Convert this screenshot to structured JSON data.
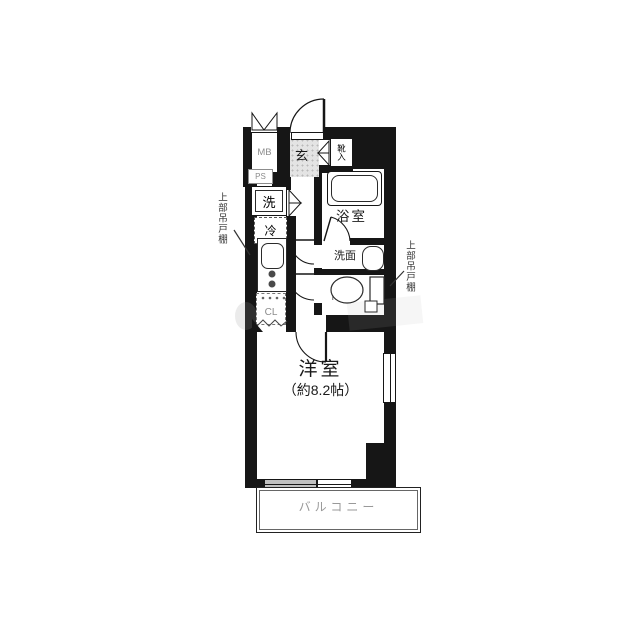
{
  "plan": {
    "type": "apartment-floor-plan",
    "rooms": {
      "main_room": {
        "name": "洋室",
        "size_note": "（約8.2帖）"
      },
      "balcony": {
        "name": "バルコニー"
      },
      "bathroom": {
        "name": "浴室"
      },
      "washroom": {
        "name": "洗面"
      },
      "toilet": {
        "name": "トイレ"
      },
      "entrance": {
        "name": "玄"
      },
      "shoe_cabinet": {
        "name": "靴入"
      },
      "closet": {
        "name": "CL"
      },
      "meter_box": {
        "name": "MB"
      },
      "pipe_space": {
        "name": "PS"
      },
      "washing_machine": {
        "name": "洗"
      },
      "refrigerator": {
        "name": "冷"
      }
    },
    "annotations": {
      "upper_cupboard_left": "上部吊戸棚",
      "upper_cupboard_right": "上部吊戸棚"
    },
    "colors": {
      "wall": "#161616",
      "line": "#2a2a2a",
      "muted_text": "#8c8c8c",
      "entrance_hatch": "#e4e4e4",
      "window_shade": "#c0c0c0"
    }
  }
}
